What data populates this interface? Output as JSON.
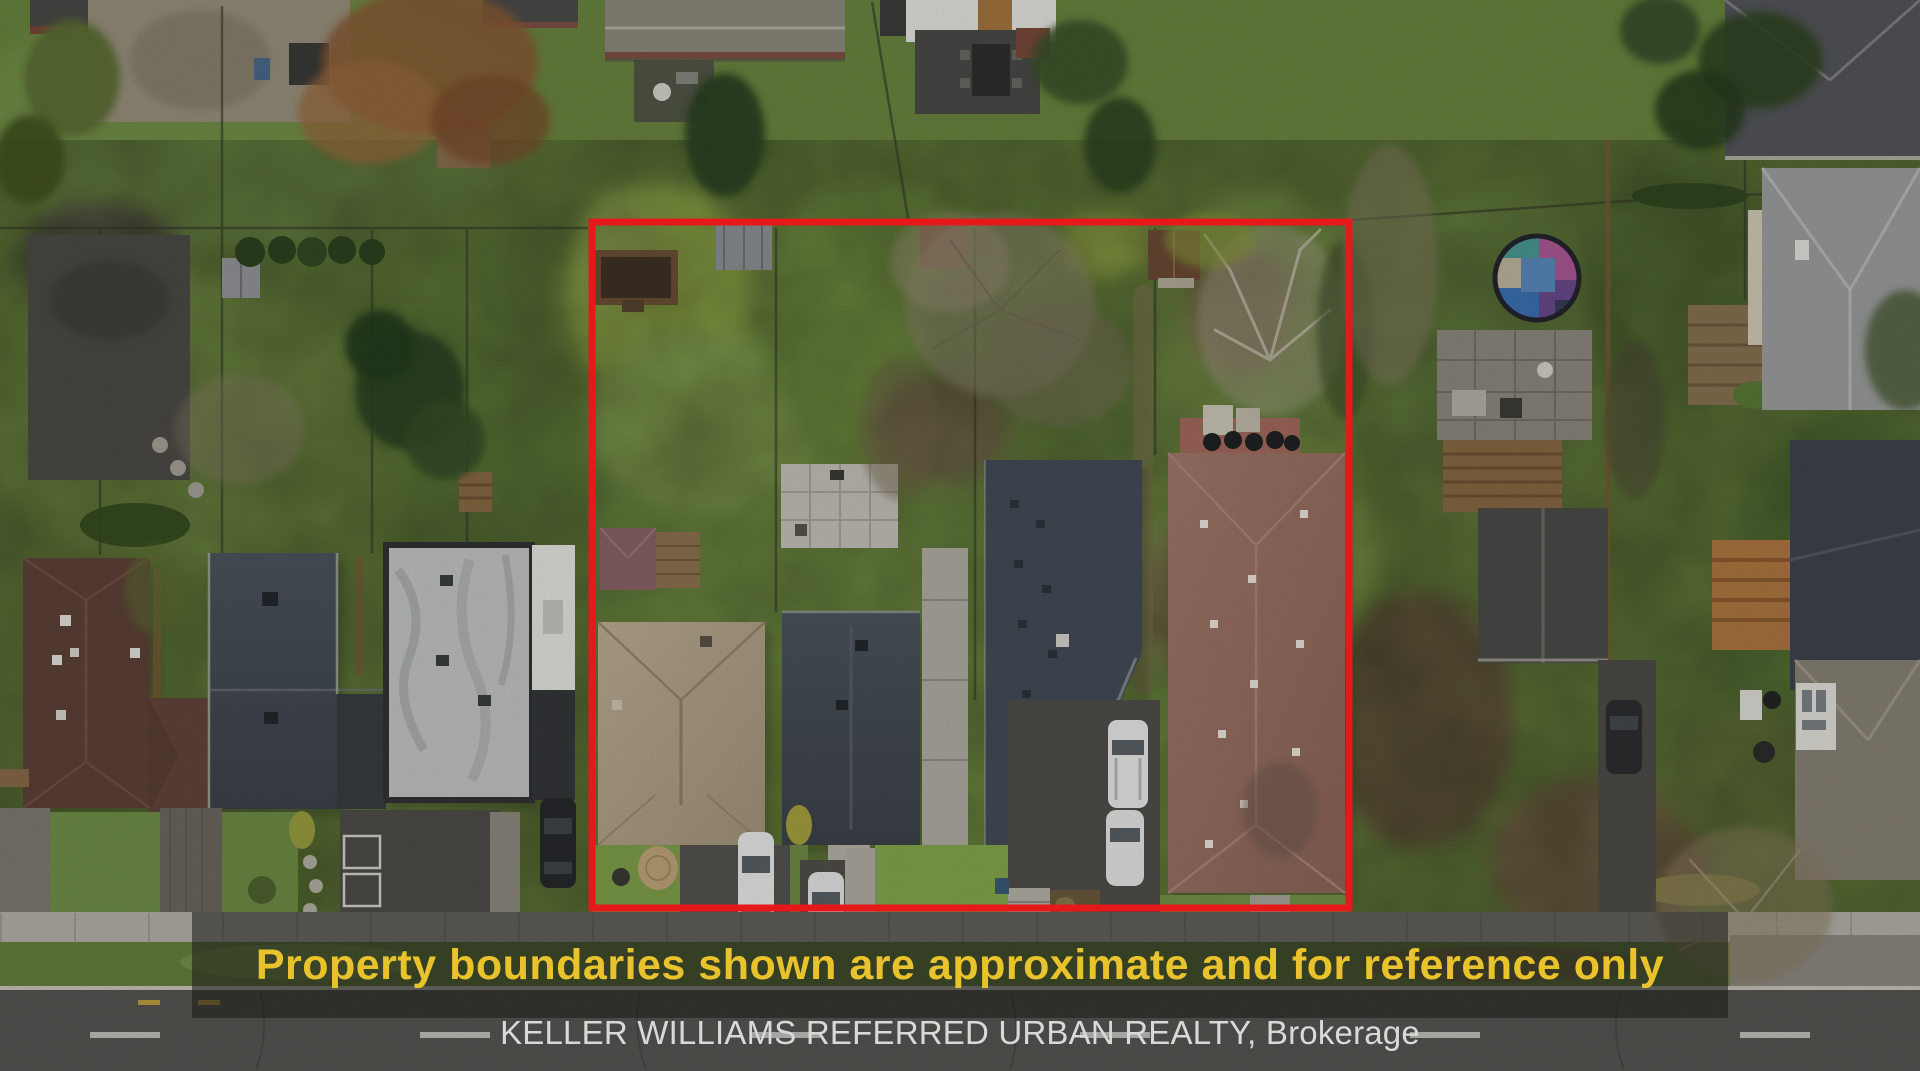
{
  "overlay": {
    "disclaimer": "Property boundaries shown are approximate and for reference only",
    "brokerage": "KELLER WILLIAMS REFERRED URBAN REALTY, Brokerage"
  },
  "colors": {
    "boundary_red": "#e5191a",
    "disclaimer_yellow": "#e9c32b",
    "brokerage_text": "#d9d9d7",
    "banner_overlay": "rgba(26,25,21,0.55)"
  }
}
